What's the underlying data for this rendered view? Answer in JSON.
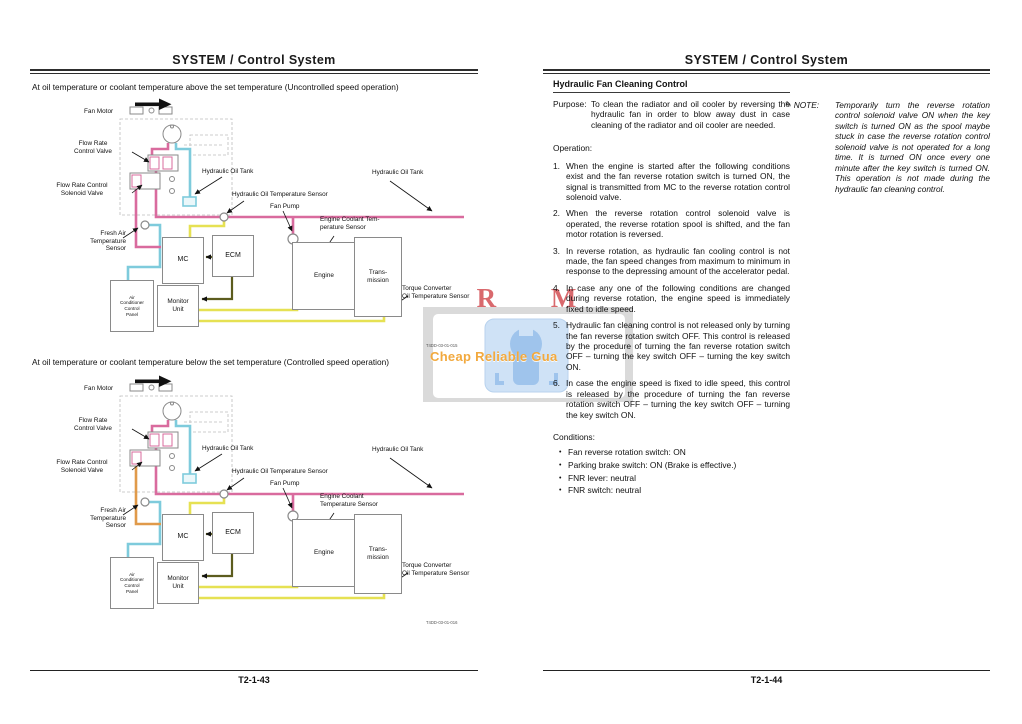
{
  "left_page": {
    "header": "SYSTEM / Control System",
    "caption_uncontrolled": "At oil temperature or coolant temperature above the set temperature (Uncontrolled speed operation)",
    "caption_controlled": "At oil temperature or coolant temperature below the set temperature (Controlled speed operation)",
    "page_number": "T2-1-43"
  },
  "diagram_labels": {
    "fan_motor": "Fan Motor",
    "flow_rate_control_valve": "Flow Rate\nControl Valve",
    "flow_rate_control_solenoid_valve": "Flow Rate Control\nSolenoid Valve",
    "hydraulic_oil_tank": "Hydraulic Oil Tank",
    "hydraulic_oil_temperature_sensor": "Hydraulic Oil Temperature Sensor",
    "fan_pump": "Fan Pump",
    "fresh_air_temperature_sensor": "Fresh Air\nTemperature\nSensor",
    "torque_converter_oil_temperature_sensor": "Torque Converter\nOil Temperature Sensor",
    "mc": "MC",
    "ecm": "ECM",
    "monitor_unit": "Monitor\nUnit",
    "air_conditioner_control_panel": "Air\nConditioner\nControl\nPanel",
    "engine": "Engine",
    "transmission": "Trans-\nmission"
  },
  "diagram1": {
    "engine_coolant_label": "Engine Coolant Tem-\nperature Sensor",
    "code": "T4DD-03-01-015",
    "control_line_color": "#d96b9e"
  },
  "diagram2": {
    "engine_coolant_label": "Engine Coolant\nTemperature Sensor",
    "code": "T4DD-03-01-016",
    "control_line_color": "#e09a4a"
  },
  "line_colors": {
    "hydraulic_supply": "#d96b9e",
    "tank_return": "#7ecbdc",
    "signal": "#e6e153",
    "ecm_link": "#5c5c1e"
  },
  "right_page": {
    "header": "SYSTEM / Control System",
    "section_title": "Hydraulic Fan Cleaning Control",
    "purpose_label": "Purpose:",
    "purpose_text": "To clean the radiator and oil cooler by reversing the hydraulic fan in order to blow away dust in case cleaning of the radiator and oil cooler are needed.",
    "operation_label": "Operation:",
    "operation_items": [
      "When the engine is started after the following conditions exist and the fan reverse rotation switch is turned ON, the signal is transmitted from MC to the reverse rotation control solenoid valve.",
      "When the reverse rotation control solenoid valve is operated, the reverse rotation spool is shifted, and the fan motor rotation is reversed.",
      "In reverse rotation, as hydraulic fan cooling control is not made, the fan speed changes from maximum to minimum in response to the depressing amount of the accelerator pedal.",
      "In case any one of the following conditions are changed during reverse rotation, the engine speed is immediately fixed to idle speed.",
      "Hydraulic fan cleaning control is not released only by turning the fan reverse rotation switch OFF. This control is released by the procedure of turning the fan reverse rotation switch OFF – turning the key switch OFF – turning the key switch ON.",
      "In case the engine speed is fixed to idle speed, this control is released by the procedure of turning the fan reverse rotation switch OFF – turning the key switch OFF – turning the key switch ON."
    ],
    "conditions_label": "Conditions:",
    "conditions_items": [
      "Fan reverse rotation switch: ON",
      "Parking brake switch: ON (Brake is effective.)",
      "FNR lever: neutral",
      "FNR switch: neutral"
    ],
    "note_label": "NOTE:",
    "note_icon": "pencil-note-icon",
    "note_text": "Temporarily turn the reverse rotation control solenoid valve ON when the key switch is turned ON as the spool maybe stuck in case the reverse rotation control solenoid valve is not operated for a long time. It is turned ON once every one minute after the key switch is turned ON. This operation is not made during the hydraulic fan cleaning control.",
    "page_number": "T2-1-44"
  },
  "watermark": {
    "title": "R M",
    "subtitle": "Cheap Reliable Gua",
    "title_color": "#d4555a",
    "subtitle_color": "#f2a93e",
    "icon": "wrench-badge-icon"
  }
}
